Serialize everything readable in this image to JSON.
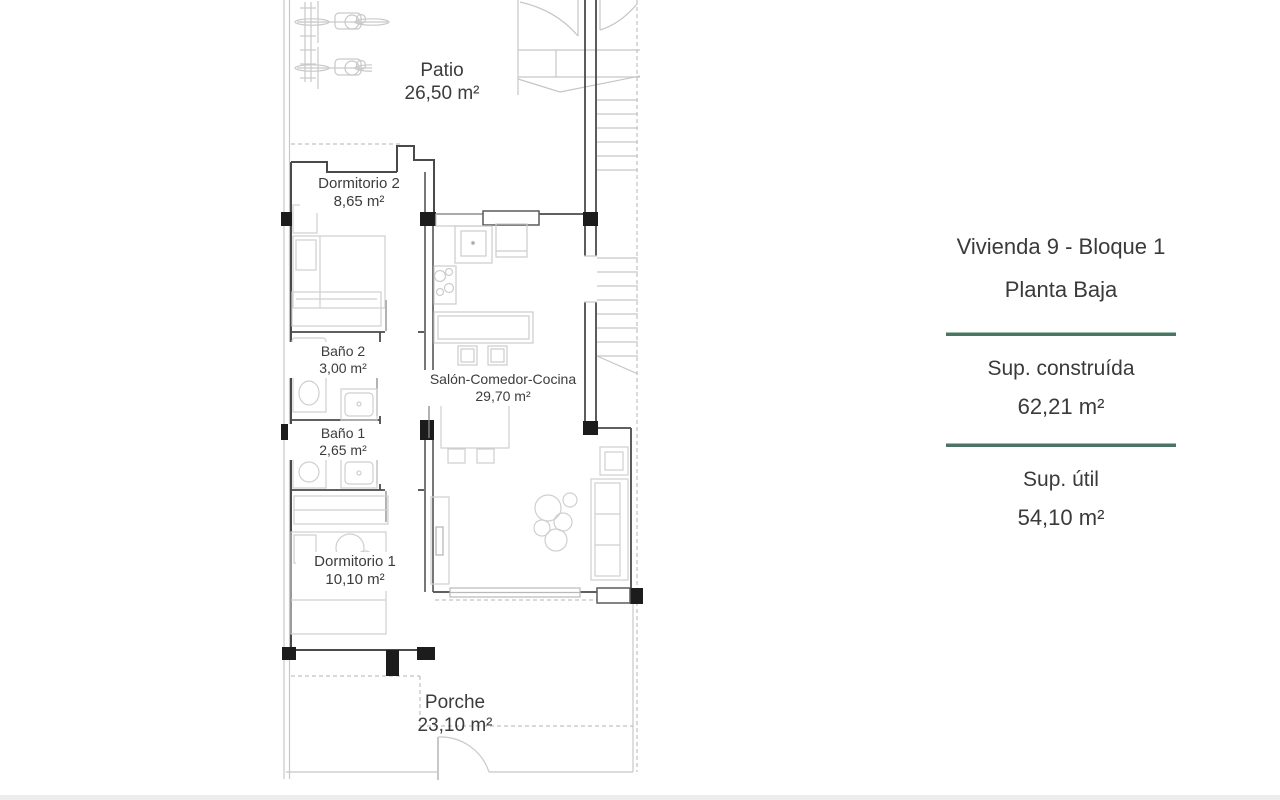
{
  "colors": {
    "divider_teal": "#4d7365",
    "text_dark": "#3c3c3c",
    "wall_dark": "#4a4a4a",
    "column_black": "#1c1c1c",
    "light_line": "#c7c7c7"
  },
  "plan": {
    "rooms": [
      {
        "name": "Patio",
        "area": "26,50 m²"
      },
      {
        "name": "Dormitorio 2",
        "area": "8,65 m²"
      },
      {
        "name": "Baño 2",
        "area": "3,00 m²"
      },
      {
        "name": "Baño 1",
        "area": "2,65 m²"
      },
      {
        "name": "Salón-Comedor-Cocina",
        "area": "29,70 m²"
      },
      {
        "name": "Dormitorio 1",
        "area": "10,10 m²"
      },
      {
        "name": "Porche",
        "area": "23,10 m²"
      }
    ]
  },
  "info_panel": {
    "title": "Vivienda 9 - Bloque 1",
    "subtitle": "Planta Baja",
    "built_area_label": "Sup. construída",
    "built_area_value": "62,21 m²",
    "usable_area_label": "Sup. útil",
    "usable_area_value": "54,10 m²"
  }
}
